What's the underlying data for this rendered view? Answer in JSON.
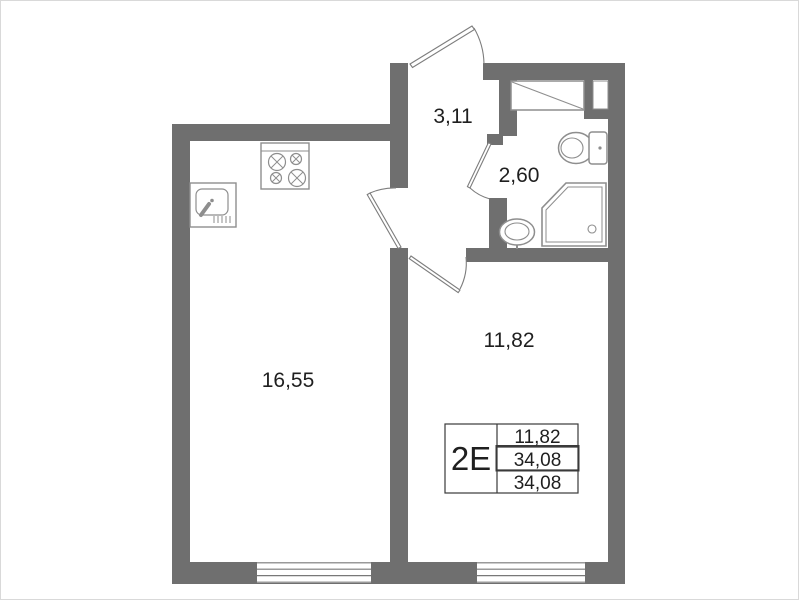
{
  "plan": {
    "title": "apartment floor plan",
    "unit_code": "2Е",
    "rooms": [
      {
        "id": "kitchen-living",
        "area": "16,55"
      },
      {
        "id": "bedroom",
        "area": "11,82"
      },
      {
        "id": "hallway",
        "area": "3,11"
      },
      {
        "id": "bathroom",
        "area": "2,60"
      }
    ],
    "info_table": {
      "unit": "2Е",
      "rows": [
        {
          "value": "11,82"
        },
        {
          "value": "34,08"
        },
        {
          "value": "34,08"
        }
      ]
    },
    "fixtures": [
      "stove-icon",
      "kitchen-sink-icon",
      "toilet-icon",
      "shower-icon",
      "bathroom-sink-icon",
      "wardrobe-icon",
      "entrance-door-icon",
      "kitchen-door-icon",
      "room-door-icon",
      "bathroom-door-icon",
      "window-left",
      "window-right"
    ],
    "colors": {
      "wall": "#6f6f6f",
      "fixture": "#8e8e8e",
      "door": "#7d7d7d",
      "text": "#1f1f1f",
      "table_border": "#3a3a3a",
      "background": "#ffffff"
    }
  }
}
